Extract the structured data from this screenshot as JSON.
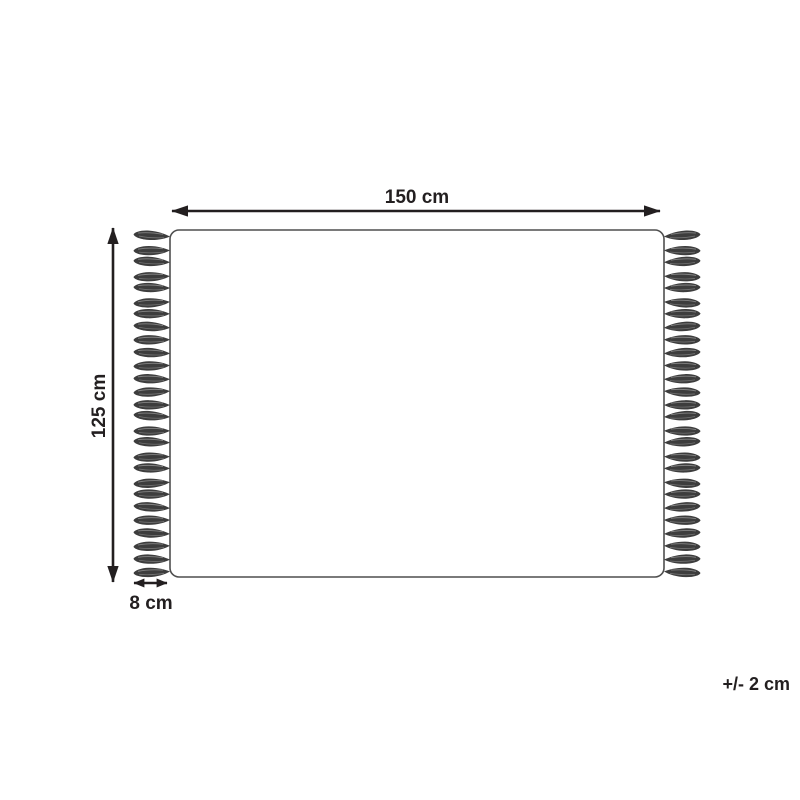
{
  "diagram": {
    "type": "product-dimension-diagram",
    "subject": "rug-with-fringe",
    "labels": {
      "width": "150 cm",
      "height": "125 cm",
      "fringe": "8 cm",
      "tolerance": "+/- 2 cm"
    },
    "dimensions": {
      "width_value_cm": 150,
      "height_value_cm": 125,
      "fringe_length_cm": 8,
      "tolerance_cm": 2
    },
    "fringe": {
      "tassels_per_side": 27,
      "sides": [
        "left",
        "right"
      ]
    },
    "colors": {
      "arrow_and_text": "#231f20",
      "rug_outline": "#4f4f4f",
      "tassel": "#3d3d3d",
      "tassel_highlight": "#8f8f8f",
      "background": "#ffffff"
    }
  }
}
